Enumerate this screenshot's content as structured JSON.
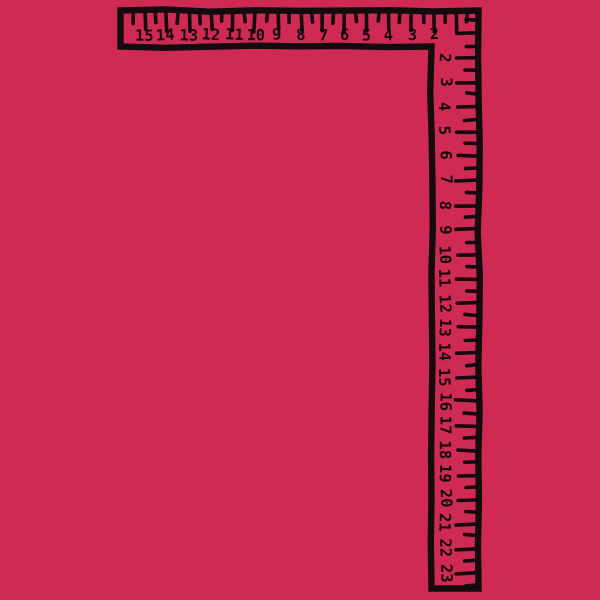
{
  "illustration": {
    "object_label": "carpenter-square-ruler",
    "background_color": "#cf2a53",
    "ink_color": "#150a0e"
  },
  "horizontal_ruler": {
    "numbers": [
      "15",
      "14",
      "13",
      "12",
      "11",
      "10",
      "9",
      "8",
      "7",
      "6",
      "5",
      "4",
      "3",
      "2"
    ]
  },
  "vertical_ruler": {
    "numbers": [
      "2",
      "3",
      "4",
      "5",
      "6",
      "7",
      "8",
      "9",
      "10",
      "11",
      "12",
      "13",
      "14",
      "15",
      "16",
      "17",
      "18",
      "19",
      "20",
      "21",
      "22",
      "23"
    ]
  }
}
